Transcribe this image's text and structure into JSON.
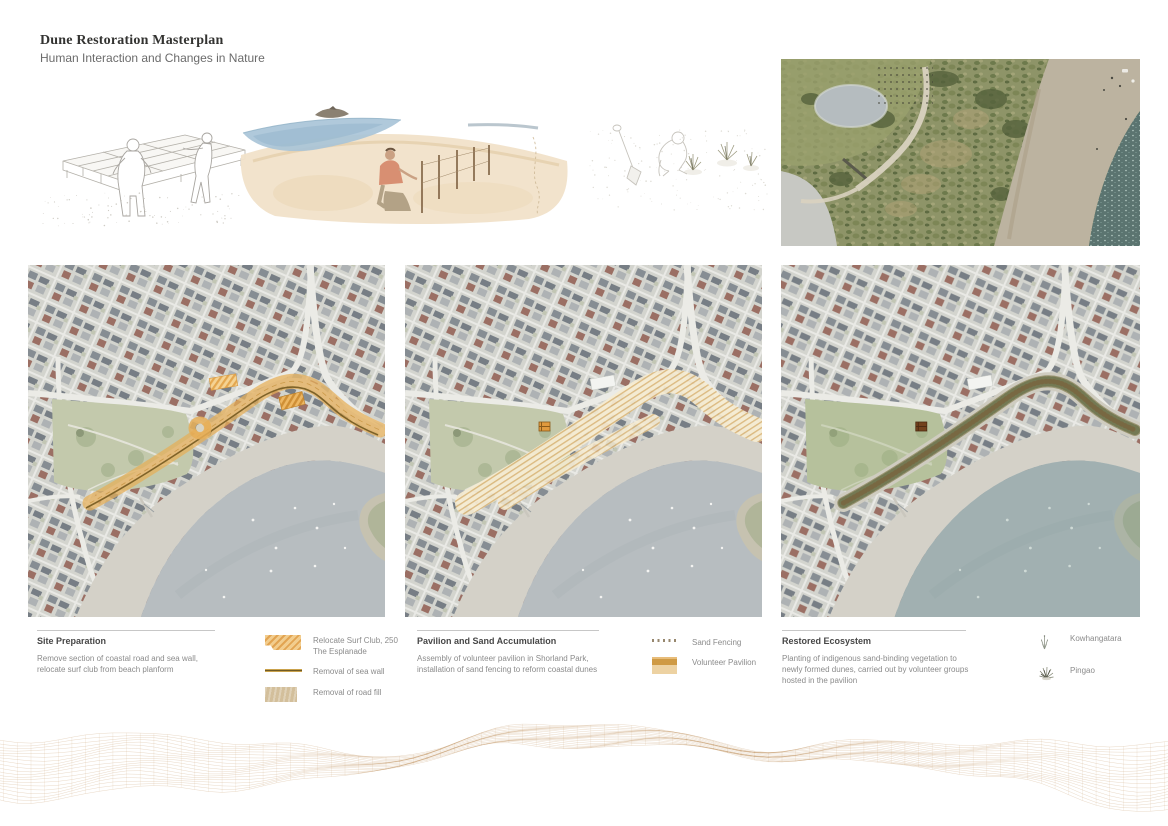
{
  "header": {
    "title": "Dune Restoration Masterplan",
    "subtitle": "Human Interaction and Changes in Nature"
  },
  "sections": [
    {
      "heading": "Site Preparation",
      "body": "Remove section of coastal road and sea wall, relocate surf club from beach planform",
      "legend": [
        {
          "icon": "surf-club-hatch-swatch",
          "label": "Relocate Surf Club, 250 The Esplanade"
        },
        {
          "icon": "sea-wall-line-swatch",
          "label": "Removal of sea wall"
        },
        {
          "icon": "road-fill-swatch",
          "label": "Removal of road fill"
        }
      ]
    },
    {
      "heading": "Pavilion and Sand Accumulation",
      "body": "Assembly of volunteer pavilion in Shorland Park, installation of sand fencing to reform coastal dunes",
      "legend": [
        {
          "icon": "sand-fencing-dotted-line",
          "label": "Sand Fencing"
        },
        {
          "icon": "volunteer-pavilion-swatch",
          "label": "Volunteer Pavilion"
        }
      ]
    },
    {
      "heading": "Restored Ecosystem",
      "body": "Planting of indigenous sand-binding vegetation to newly formed dunes, carried out by volunteer groups hosted in the pavilion",
      "legend": [
        {
          "icon": "kowhangatara-plant-icon",
          "label": "Kowhangatara"
        },
        {
          "icon": "pingao-grass-icon",
          "label": "Pingao"
        }
      ]
    }
  ],
  "colors": {
    "accent_orange": "#e6ae57",
    "hatch_orange": "#e2a452",
    "road_fill_tan": "#d3bf9b",
    "sea_wall_brown": "#73591f",
    "pavilion_orange": "#cf9a44",
    "mesh_tan": "#c79f72",
    "map_sea": "#b7bdc0",
    "restored_sea_tint": "#5e8d84"
  }
}
